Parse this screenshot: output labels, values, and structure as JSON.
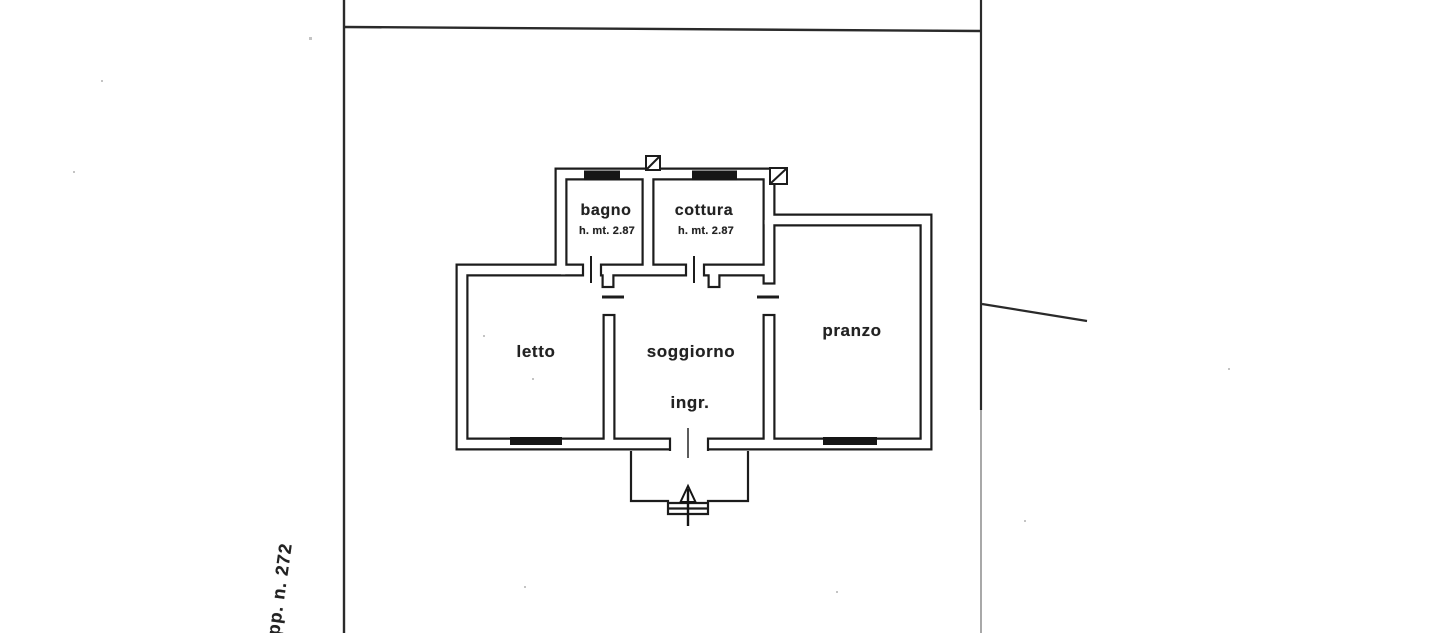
{
  "page": {
    "kind": "scanned cadastral floor plan",
    "colors": {
      "ink": "#1c1c1c",
      "paper": "#ffffff"
    }
  },
  "plan": {
    "rooms": [
      {
        "key": "bagno",
        "label": "bagno",
        "note": "h. mt. 2.87"
      },
      {
        "key": "cottura",
        "label": "cottura",
        "note": "h. mt. 2.87"
      },
      {
        "key": "letto",
        "label": "letto"
      },
      {
        "key": "soggiorno",
        "label": "soggiorno"
      },
      {
        "key": "ingresso",
        "label": "ingr."
      },
      {
        "key": "pranzo",
        "label": "pranzo"
      }
    ],
    "annotations": {
      "parcel": "pp. n. 272"
    }
  }
}
